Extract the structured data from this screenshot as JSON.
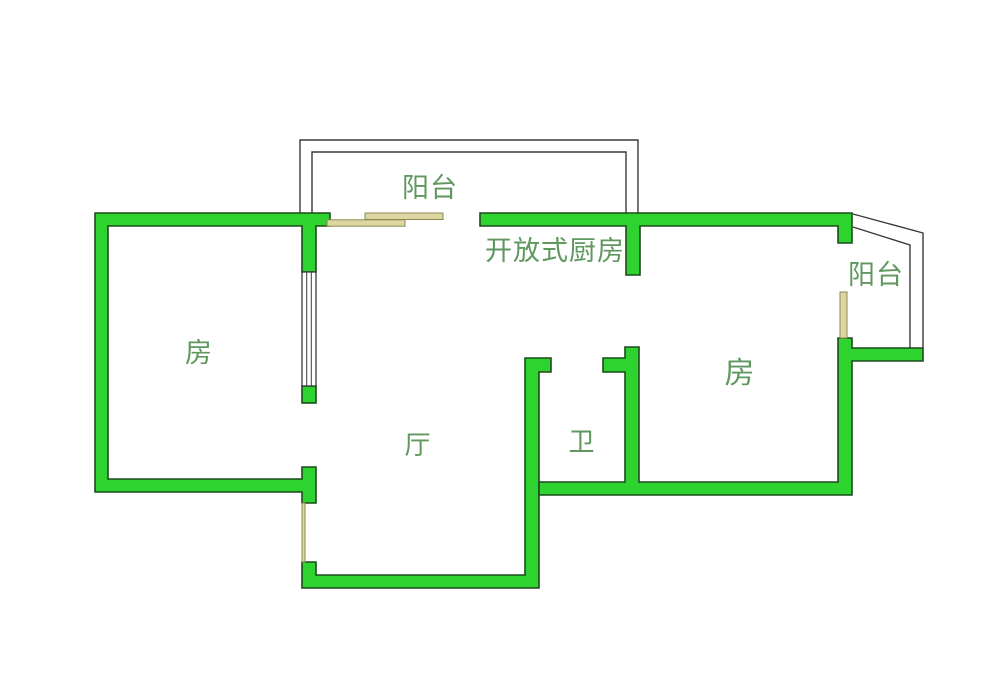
{
  "floor_plan": {
    "labels": {
      "balcony_top": "阳台",
      "open_kitchen": "开放式厨房",
      "balcony_right": "阳台",
      "bedroom_left": "房",
      "living_room": "厅",
      "bathroom": "卫",
      "bedroom_right": "房"
    },
    "colors": {
      "wall_fill": "#2fd32f",
      "wall_stroke": "#1e4a1e",
      "balcony_outline": "#3a3a3a",
      "door_window_fill": "#ddd6a3",
      "door_window_stroke": "#8a8a50",
      "label_text": "#5f975f",
      "background": "#ffffff"
    }
  }
}
